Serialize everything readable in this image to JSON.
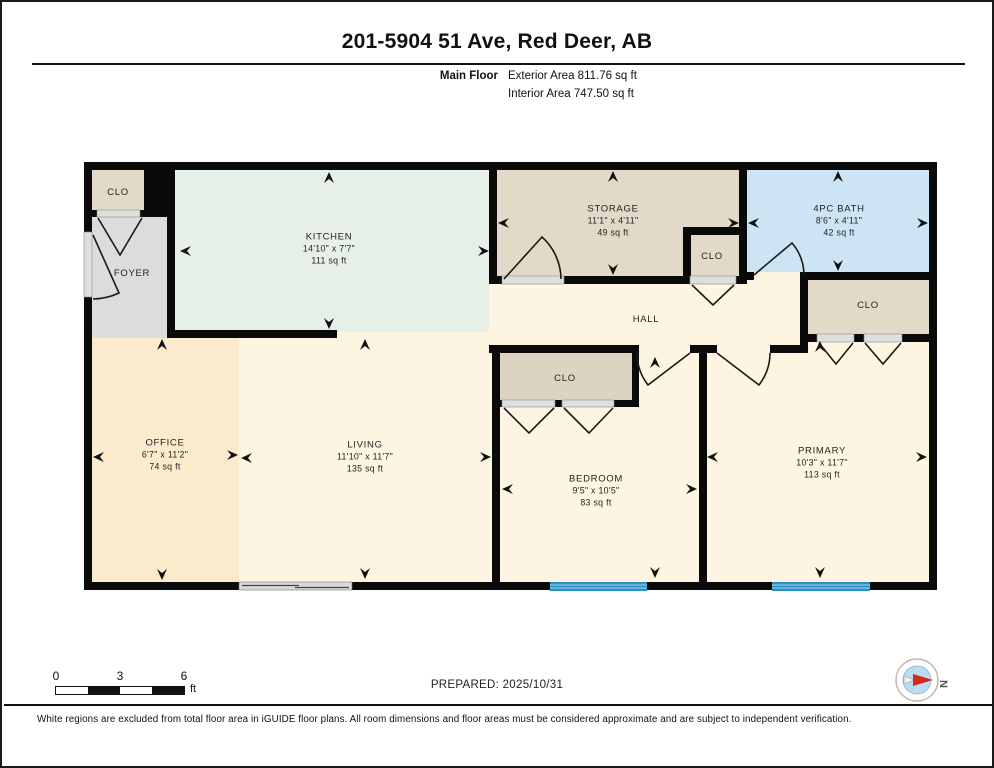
{
  "header": {
    "title": "201-5904 51 Ave, Red Deer, AB",
    "floor_label": "Main Floor",
    "exterior_area": "Exterior Area 811.76 sq ft",
    "interior_area": "Interior Area 747.50 sq ft"
  },
  "rooms": {
    "kitchen": {
      "name": "KITCHEN",
      "dims": "14'10\" x 7'7\"",
      "area": "111 sq ft"
    },
    "storage": {
      "name": "STORAGE",
      "dims": "11'1\" x 4'11\"",
      "area": "49 sq ft"
    },
    "bath": {
      "name": "4PC BATH",
      "dims": "8'6\" x 4'11\"",
      "area": "42 sq ft"
    },
    "office": {
      "name": "OFFICE",
      "dims": "6'7\" x 11'2\"",
      "area": "74 sq ft"
    },
    "living": {
      "name": "LIVING",
      "dims": "11'10\" x 11'7\"",
      "area": "135 sq ft"
    },
    "bedroom": {
      "name": "BEDROOM",
      "dims": "9'5\" x 10'5\"",
      "area": "83 sq ft"
    },
    "primary": {
      "name": "PRIMARY",
      "dims": "10'3\" x 11'7\"",
      "area": "113 sq ft"
    },
    "foyer": {
      "name": "FOYER"
    },
    "hall": {
      "name": "HALL"
    },
    "closet_entry": {
      "name": "CLO"
    },
    "closet_hall": {
      "name": "CLO"
    },
    "closet_primary": {
      "name": "CLO"
    },
    "closet_bedroom": {
      "name": "CLO"
    }
  },
  "footer": {
    "scale": {
      "t0": "0",
      "t1": "3",
      "t2": "6",
      "unit": "ft"
    },
    "prepared": "PREPARED: 2025/10/31",
    "compass_label": "N",
    "disclaimer": "White regions are excluded from total floor area in iGUIDE floor plans. All room dimensions and floor areas must be considered approximate and are subject to independent verification."
  },
  "colors": {
    "wall": "#0a0a0a",
    "cream": "#fdf5e1",
    "kitchen_mint": "#e7efe9",
    "closet_tan": "#e3d9c8",
    "foyer_gray": "#dcdcdc",
    "office_peach": "#fbebcc",
    "bath_blue": "#cde4f4",
    "window_blue": "#2f8fc0",
    "window_stripe": "#79c0e2",
    "compass_red": "#d6281e",
    "compass_blue": "#bcdcf0"
  }
}
